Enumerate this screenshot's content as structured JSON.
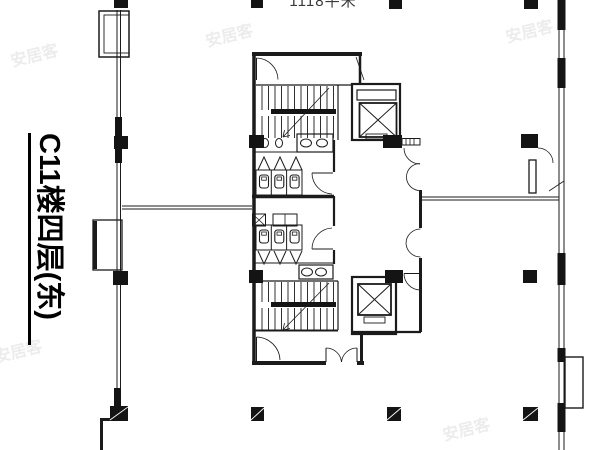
{
  "labels": {
    "title": "C11楼四层(东)",
    "area": "1118平米",
    "watermark": "安居客"
  },
  "colors": {
    "background": "#ffffff",
    "ink": "#1b1b1b",
    "watermark": "#ececec"
  },
  "plan": {
    "type": "architectural-floor-plan",
    "symbols": [
      "stair-upper",
      "stair-lower",
      "elevator-upper",
      "elevator-lower",
      "restroom-men",
      "restroom-women",
      "sink-counter",
      "toilet-stall",
      "urinal-partition",
      "door-swing",
      "double-door",
      "window-bay",
      "structural-column"
    ]
  }
}
